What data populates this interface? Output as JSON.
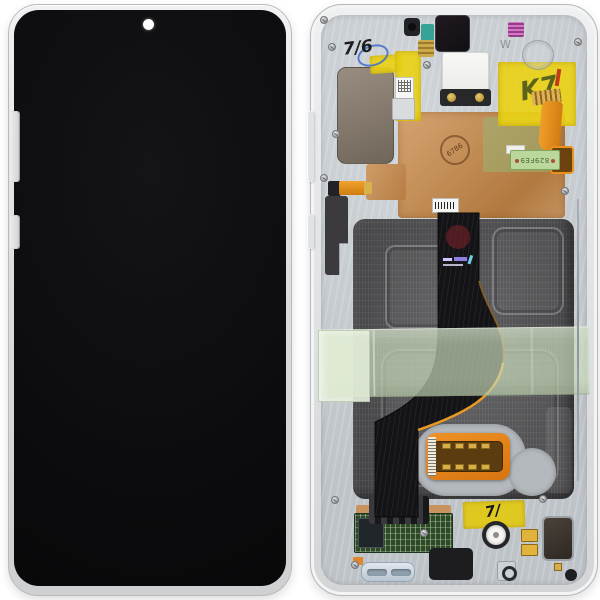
{
  "scene": {
    "subject": "smartphone-display-assembly-front-and-back",
    "background_color": "#ffffff"
  },
  "front": {
    "frame_color": "#d9dadc",
    "screen_color": "#0b0b0d",
    "punch_hole_color": "#ffffff"
  },
  "back": {
    "frame_color": "#e0e2e4",
    "chassis_color": "#c5cacf",
    "battery_well_color": "#4e4e50",
    "copper_foil_color": "#c08a53",
    "kapton_tape_color": "#e9d116",
    "green_tape_color": "#cbddbc",
    "display_flex_color": "#141417",
    "orange_flex_color": "#e8921f",
    "pcb_color": "#2c4a28",
    "markings": {
      "handwritten_date": "7/6",
      "chassis_letter": "W",
      "kapton_scribble": "K7",
      "pcb_strip_code": "829FE9",
      "copper_stamp": "6786",
      "bottom_tape_mark": "7/"
    }
  }
}
